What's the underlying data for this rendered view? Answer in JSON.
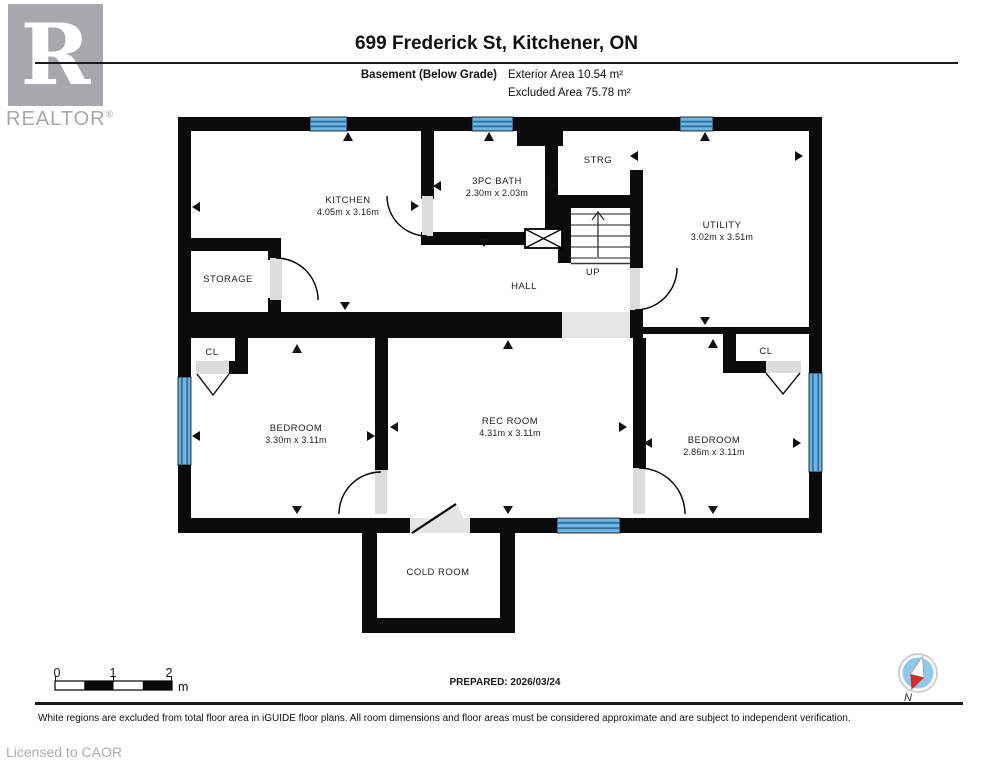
{
  "header": {
    "title": "699 Frederick St, Kitchener, ON",
    "floor_label": "Basement (Below Grade)",
    "exterior_area": "Exterior Area 10.54 m²",
    "excluded_area": "Excluded Area 75.78 m²",
    "logo_letter": "R",
    "logo_text": "REALTOR",
    "logo_reg": "®"
  },
  "rooms": {
    "kitchen": {
      "name": "KITCHEN",
      "dims": "4.05m x 3.16m"
    },
    "bath": {
      "name": "3PC BATH",
      "dims": "2.30m x 2.03m"
    },
    "strg": {
      "name": "STRG"
    },
    "utility": {
      "name": "UTILITY",
      "dims": "3.02m x 3.51m"
    },
    "storage": {
      "name": "STORAGE"
    },
    "hall": {
      "name": "HALL"
    },
    "stairs_up": {
      "name": "UP"
    },
    "cl_left": {
      "name": "CL"
    },
    "cl_right": {
      "name": "CL"
    },
    "bedroom_left": {
      "name": "BEDROOM",
      "dims": "3.30m x 3.11m"
    },
    "rec_room": {
      "name": "REC ROOM",
      "dims": "4.31m x 3.11m"
    },
    "bedroom_right": {
      "name": "BEDROOM",
      "dims": "2.86m x 3.11m"
    },
    "cold_room": {
      "name": "COLD ROOM"
    }
  },
  "footer": {
    "scale": {
      "t0": "0",
      "t1": "1",
      "t2": "2",
      "unit": "m"
    },
    "prepared": "PREPARED: 2026/03/24",
    "compass_label": "N",
    "disclaimer": "White regions are excluded from total floor area in iGUIDE floor plans. All room dimensions and floor areas must be considered approximate and are subject to independent verification.",
    "licensed": "Licensed to CAOR"
  },
  "colors": {
    "wall_black": "#0B0B0B",
    "window_blue": "#6FB6E3",
    "window_line": "#2E6F9D",
    "door_grey": "#DCDCDC",
    "logo_grey": "#A6A8AB",
    "compass_blue": "#8FC8EA",
    "compass_red": "#D42B2B"
  }
}
